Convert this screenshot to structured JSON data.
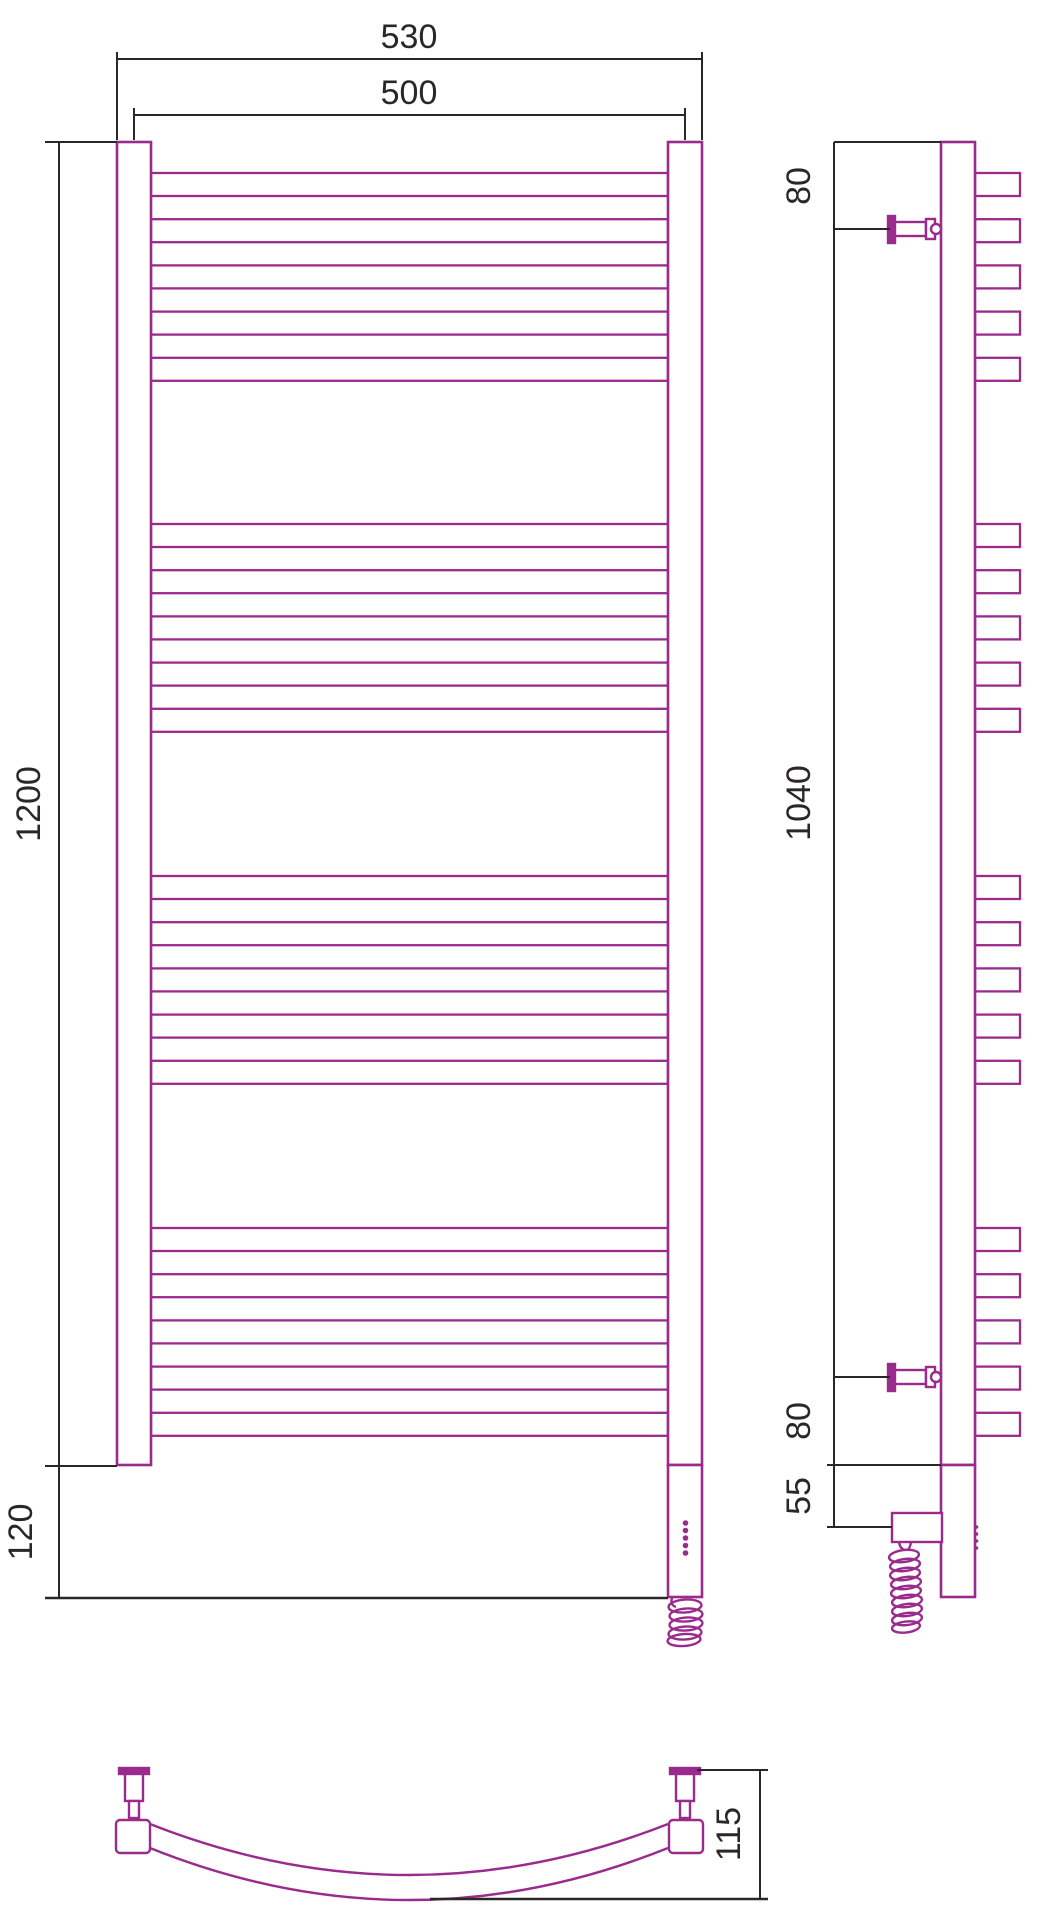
{
  "front_view": {
    "dim_overall_width": "530",
    "dim_axis_width": "500",
    "dim_height": "1200",
    "dim_heater_drop": "120",
    "rung_groups": 4,
    "rungs_per_group": 5
  },
  "side_view": {
    "dim_top_bracket_offset": "80",
    "dim_bracket_span": "1040",
    "dim_bottom_bracket_offset": "80",
    "dim_plug_offset": "55"
  },
  "bottom_view": {
    "dim_depth": "115"
  },
  "colors": {
    "accent": "#9a2b8c",
    "line": "#2b2728",
    "background": "#ffffff"
  }
}
